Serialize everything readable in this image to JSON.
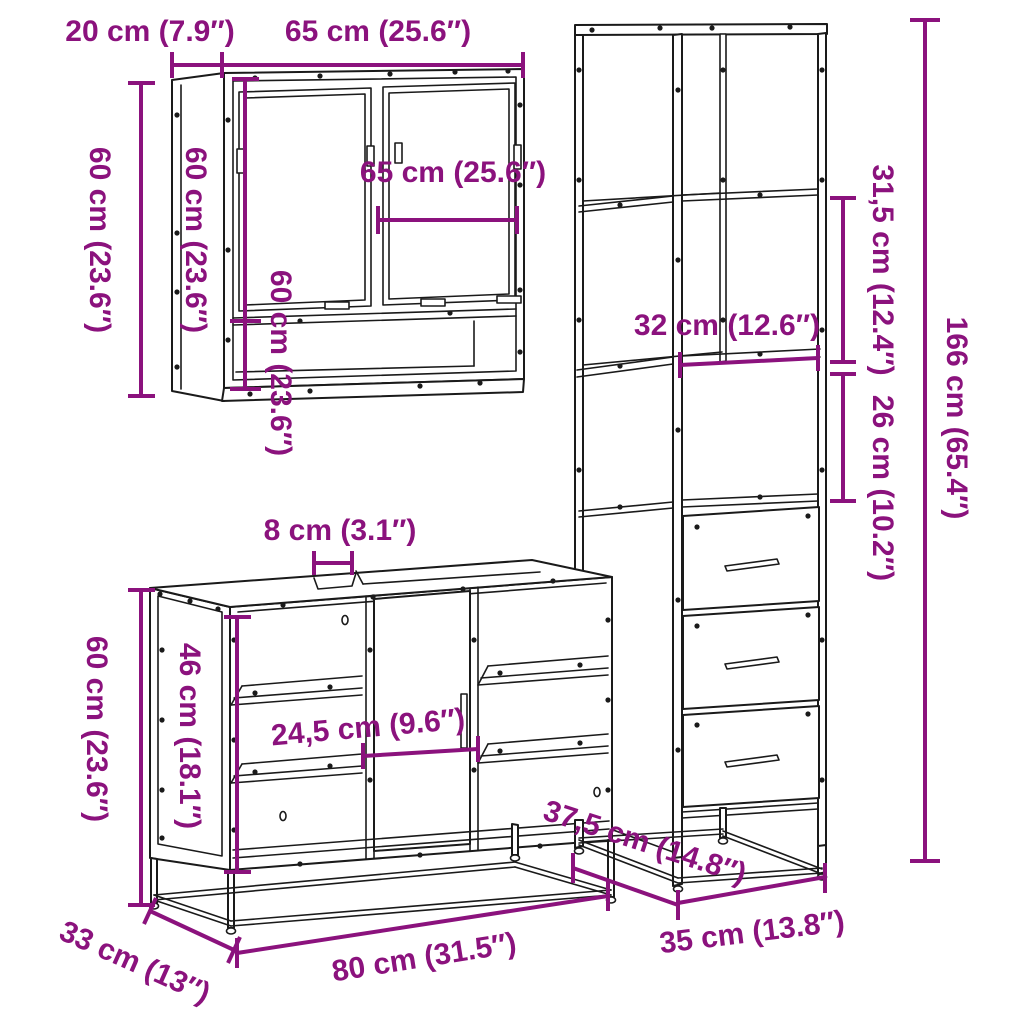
{
  "diagram": {
    "background": "#FFFFFF",
    "colors": {
      "dimension": "#8B127D",
      "line_art": "#1A1A1A"
    },
    "pieces": {
      "mirror_cabinet": {
        "dims": {
          "depth_top": "20 cm (7.9″)",
          "width_top": "65 cm (25.6″)",
          "height_outer": "60 cm (23.6″)",
          "height_side": "60 cm (23.6″)",
          "width_inner": "65 cm (25.6″)",
          "height_inner": "60 cm (23.6″)"
        }
      },
      "tall_cabinet": {
        "dims": {
          "upper_section_height": "31,5 cm (12.4″)",
          "shelf_width": "32 cm (12.6″)",
          "middle_section_height": "26 cm (10.2″)",
          "total_height": "166 cm (65.4″)",
          "depth": "37,5 cm (14.8″)",
          "width": "35 cm (13.8″)"
        }
      },
      "vanity_cabinet": {
        "dims": {
          "top_gap": "8 cm (3.1″)",
          "height": "60 cm (23.6″)",
          "inner_height": "46 cm (18.1″)",
          "door_width": "24,5 cm (9.6″)",
          "depth": "33 cm (13″)",
          "width": "80 cm (31.5″)"
        }
      }
    }
  }
}
